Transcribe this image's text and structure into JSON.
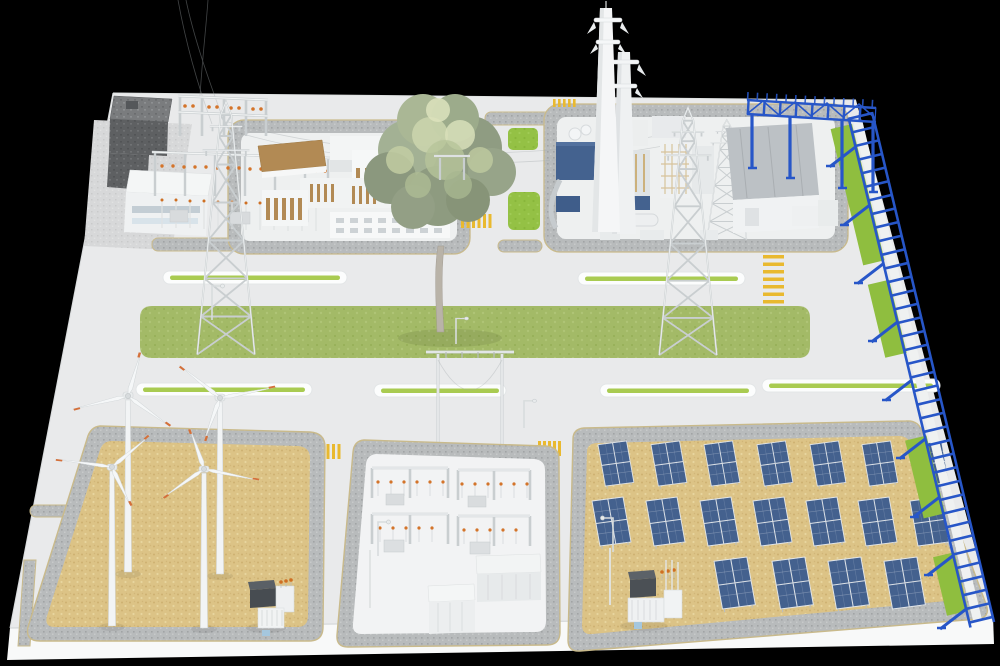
{
  "scene": {
    "type": "3d_isometric_render",
    "subject": "Integrated clean-energy park campus (wind, solar, thermal plant, substations)",
    "background_color": "#000000",
    "ground_color": "#e9eaeb"
  },
  "colors": {
    "grass": "#9cba58",
    "grass_bright": "#8fbe3f",
    "sand": "#dcc386",
    "road_speckle": "#b8bbbc",
    "road_edge_tan": "#c9ba8b",
    "solar_panel": "#44618e",
    "pipe_rack_blue": "#2756c8",
    "insulator_orange": "#d4742a",
    "marking_yellow": "#e9b92f",
    "structure_white": "#f2f4f5",
    "concrete_dark": "#77797b",
    "front_slab": "#f8f9f9"
  },
  "facilities": {
    "substation_northwest": {
      "label": "hv-substation-northwest",
      "features": [
        "dark concrete hall",
        "white control building",
        "gantry frames with orange insulators"
      ]
    },
    "industrial_building_complex": {
      "label": "industrial-building-complex",
      "features": [
        "white halls",
        "tan roofs and louvers",
        "speckled ring road"
      ]
    },
    "power_plant": {
      "label": "thermal-power-plant",
      "chimney_count": 2,
      "features": [
        "boiler island",
        "lattice tower",
        "grey roof hall"
      ]
    },
    "pipe_rack": {
      "label": "blue-pipe-rack",
      "segments": [
        "north bridge",
        "east edge run"
      ],
      "color": "#2756c8"
    },
    "wind_farm": {
      "label": "wind-farm",
      "turbine_count": 4,
      "ground": "sand",
      "pad_transformers": 1
    },
    "switchyard_south": {
      "label": "switchyard-south",
      "features": [
        "portal frames",
        "breaker rows with orange insulators",
        "service buildings"
      ]
    },
    "solar_farm": {
      "label": "solar-farm",
      "pv_table_count": 18,
      "rows": [
        7,
        7,
        4
      ],
      "ground": "sand",
      "inverter_stations": 1
    },
    "transmission_towers": {
      "count": 2
    },
    "tree": {
      "count": 1
    },
    "central_green_strip": {
      "count": 1
    },
    "planter_pills": {
      "count": 6
    },
    "crosswalks": {
      "count": 5
    },
    "street_lamps": {
      "count": 5
    }
  }
}
